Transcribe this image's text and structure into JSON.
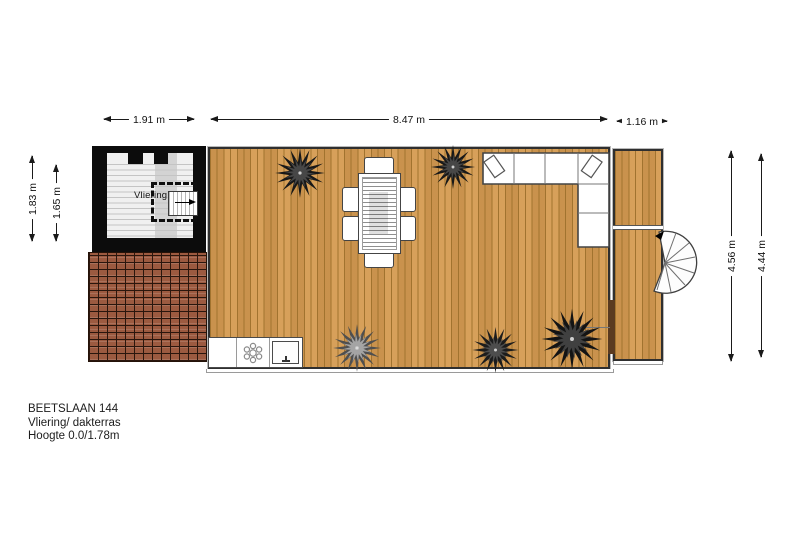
{
  "plan_title": {
    "address": "BEETSLAAN 144",
    "floor_label": "Vliering/ dakterras",
    "height_label": "Hoogte 0.0/1.78m"
  },
  "room": {
    "label": "Vliering"
  },
  "dimensions": {
    "top_width_left": {
      "label": "1.91 m"
    },
    "top_width_main": {
      "label": "8.47 m"
    },
    "top_width_right": {
      "label": "1.16 m"
    },
    "left_height_outer": {
      "label": "1.83 m"
    },
    "left_height_inner": {
      "label": "1.65 m"
    },
    "right_height_outer": {
      "label": "4.56 m"
    },
    "right_height_inner": {
      "label": "4.44 m"
    }
  },
  "colors": {
    "deck": "#d59b51",
    "deck-line": "#a1732f",
    "roof": "#9c5a40",
    "roof-line": "#2a160d",
    "wall": "#0c0c0c",
    "dim": "#1a1a1a"
  }
}
